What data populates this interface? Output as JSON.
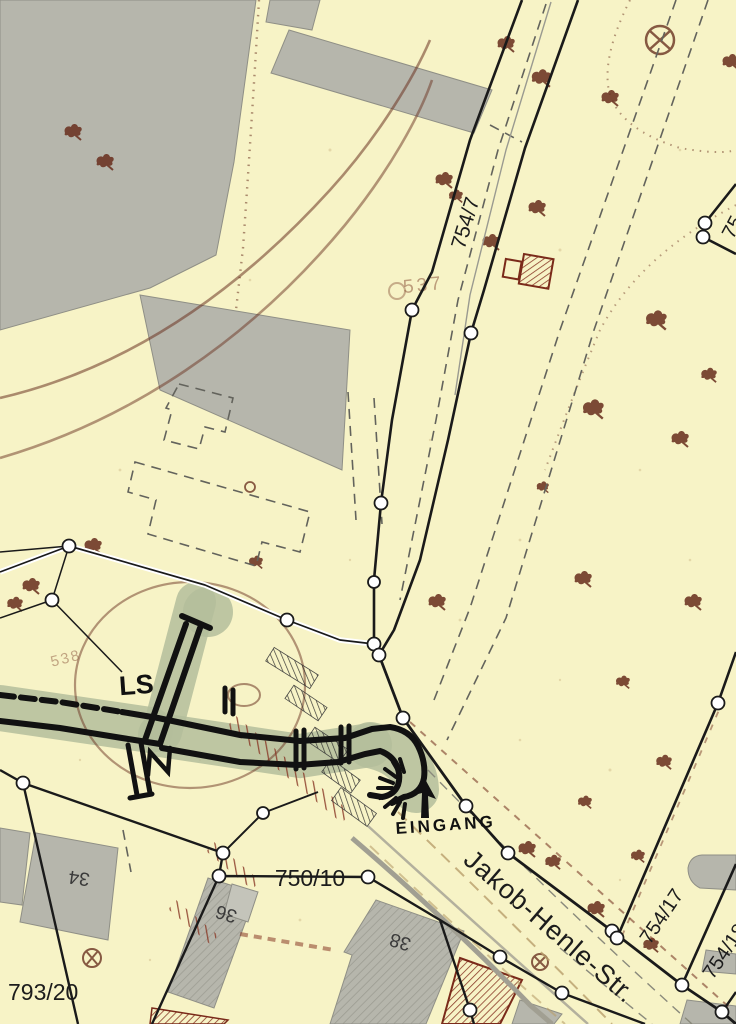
{
  "map": {
    "type": "historical-cadastral-map",
    "colors": {
      "background": "#f7f3c6",
      "building_gray": "#b6b6ac",
      "vegetation_green": "#b4bd9b",
      "sepia_brown": "#6b3322",
      "red_hatch": "#8a3a28",
      "line_black": "#1a1a1a",
      "road_gray": "#a19f92"
    },
    "labels": {
      "parcel_754_7": "754/7",
      "parcel_750_10": "750/10",
      "parcel_793_20": "793/20",
      "parcel_754_17": "754/17",
      "parcel_754_18": "754/18",
      "parcel_75_partial": "75",
      "street_name": "Jakob-Henle-Str.",
      "shelter": "LS",
      "entrance": "EINGANG",
      "house_34": "34",
      "house_36": "36",
      "house_38": "38",
      "faint_537": "537",
      "faint_538": "538"
    }
  }
}
